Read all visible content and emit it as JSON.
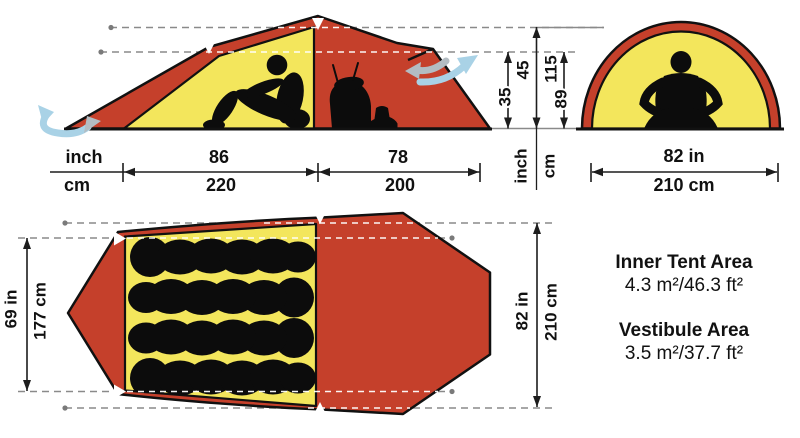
{
  "colors": {
    "tent_red": "#c5402b",
    "inner_yellow": "#f3e65c",
    "silhouette": "#0c0c0c",
    "dim_line": "#1d1d1d",
    "dash_gray": "#8a8a8a",
    "vent_blue": "#a9d2e6",
    "vent_gray": "#b3bcc2"
  },
  "side_view": {
    "unit_top": "inch",
    "unit_bottom": "cm",
    "inner_width_in": "86",
    "inner_width_cm": "220",
    "vestibule_depth_in": "78",
    "vestibule_depth_cm": "200",
    "vent_height_in": "35",
    "ridge_height_in": "45",
    "ridge_height_cm": "115",
    "vent_height_cm": "89",
    "height_unit_in": "inch",
    "height_unit_cm": "cm"
  },
  "front_view": {
    "width_in": "82 in",
    "width_cm": "210 cm"
  },
  "floor_plan": {
    "inner_width_in": "69 in",
    "inner_width_cm": "177 cm",
    "outer_width_in": "82 in",
    "outer_width_cm": "210 cm"
  },
  "areas": {
    "inner_title": "Inner Tent Area",
    "inner_value": "4.3 m²/46.3 ft²",
    "vestibule_title": "Vestibule Area",
    "vestibule_value": "3.5 m²/37.7 ft²"
  }
}
